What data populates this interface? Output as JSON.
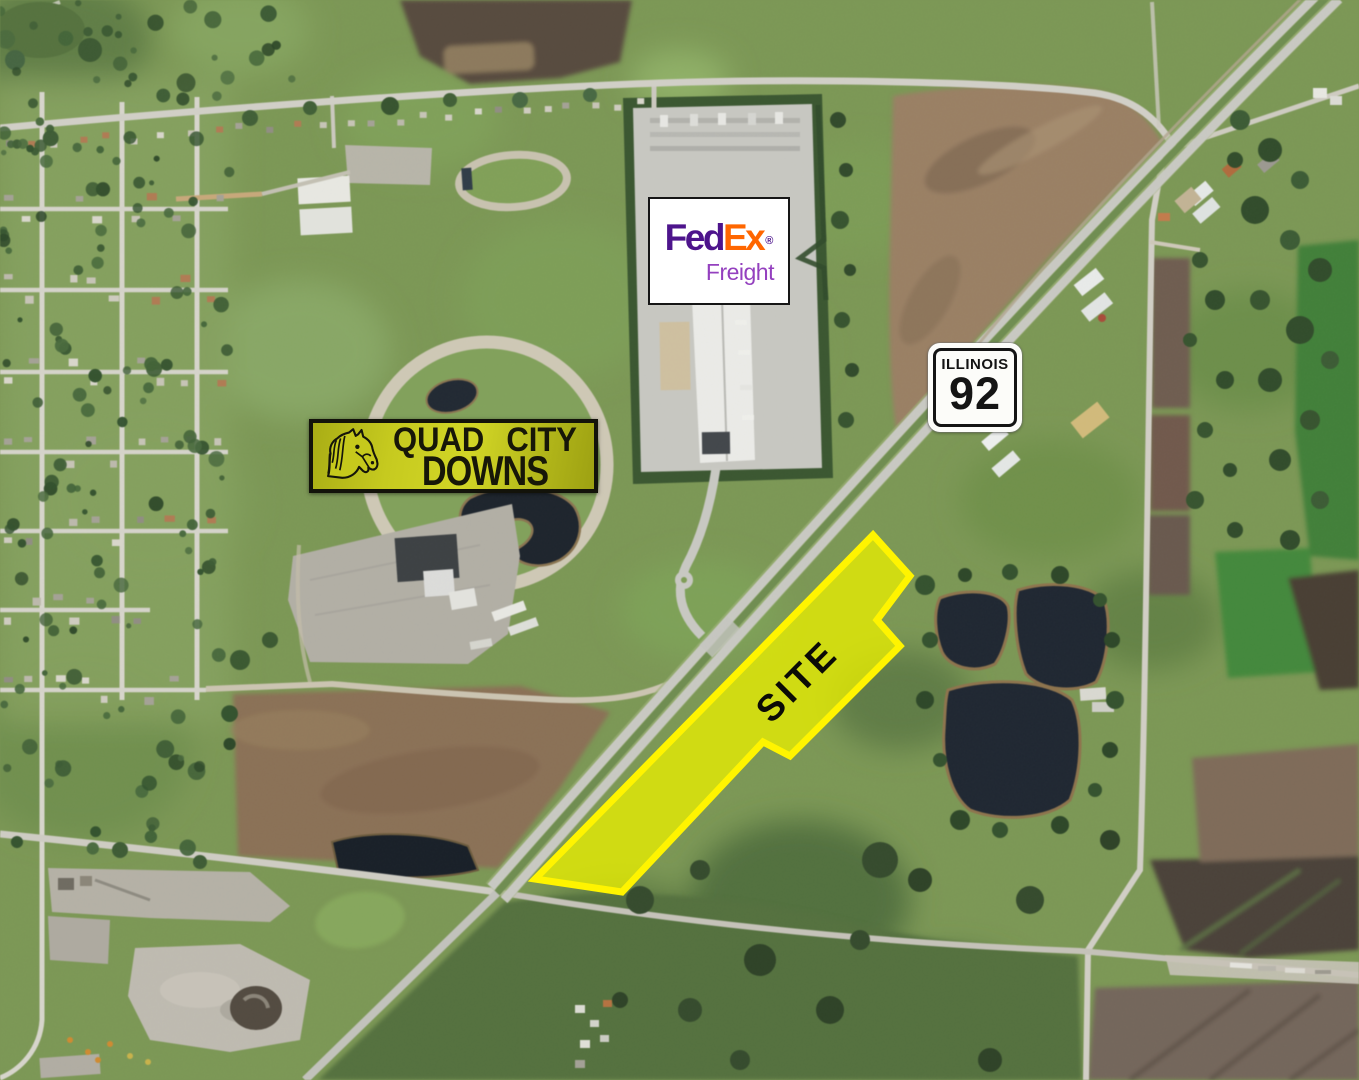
{
  "page": {
    "title": "Aerial site map"
  },
  "site": {
    "label": "SITE",
    "fill_color": "#E8EE00",
    "border_color": "#FFF400"
  },
  "shield": {
    "state": "ILLINOIS",
    "number": "92"
  },
  "racetrack_sign": {
    "word1": "QUAD",
    "word2": "CITY",
    "line2": "DOWNS",
    "background_color": "#C6CA1F",
    "text_color": "#171708"
  },
  "fedex": {
    "part1": "Fed",
    "part2": "Ex",
    "registered": "®",
    "subbrand": "Freight",
    "purple": "#4D148C",
    "orange": "#FF6600",
    "freight_purple": "#9440BF"
  }
}
